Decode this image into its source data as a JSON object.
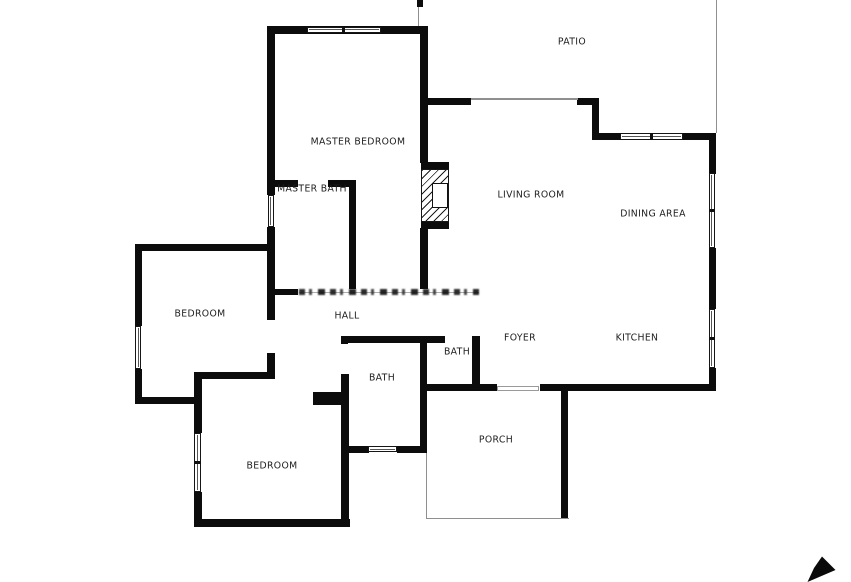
{
  "title": "Floor plan",
  "canvas": {
    "width": 851,
    "height": 582,
    "background": "#ffffff"
  },
  "colors": {
    "wall": "#0c0c0c",
    "thin_line": "#8f8f8f",
    "label_text": "#1c1c1c",
    "window_border": "#161616",
    "watermark": "#1e1e1e"
  },
  "rooms": [
    {
      "id": "patio",
      "label": "PATIO",
      "x": 572,
      "y": 42
    },
    {
      "id": "master-bedroom",
      "label": "MASTER BEDROOM",
      "x": 358,
      "y": 142
    },
    {
      "id": "master-bath",
      "label": "MASTER BATH",
      "x": 312,
      "y": 189
    },
    {
      "id": "living-room",
      "label": "LIVING ROOM",
      "x": 531,
      "y": 195
    },
    {
      "id": "dining-area",
      "label": "DINING AREA",
      "x": 653,
      "y": 214
    },
    {
      "id": "bedroom-left",
      "label": "BEDROOM",
      "x": 200,
      "y": 314
    },
    {
      "id": "hall",
      "label": "HALL",
      "x": 347,
      "y": 316
    },
    {
      "id": "foyer",
      "label": "FOYER",
      "x": 520,
      "y": 338
    },
    {
      "id": "kitchen",
      "label": "KITCHEN",
      "x": 637,
      "y": 338
    },
    {
      "id": "bath-small",
      "label": "BATH",
      "x": 457,
      "y": 352
    },
    {
      "id": "bath",
      "label": "BATH",
      "x": 382,
      "y": 378
    },
    {
      "id": "porch",
      "label": "PORCH",
      "x": 496,
      "y": 440
    },
    {
      "id": "bedroom-lower",
      "label": "BEDROOM",
      "x": 272,
      "y": 466
    }
  ],
  "walls": [
    [
      267,
      26,
      160,
      7.5
    ],
    [
      267,
      26,
      7.5,
      169
    ],
    [
      267,
      227,
      7.5,
      93
    ],
    [
      267,
      353,
      8,
      26
    ],
    [
      420,
      26,
      7.5,
      137
    ],
    [
      420,
      228,
      7.5,
      61
    ],
    [
      427,
      98,
      44,
      7
    ],
    [
      577,
      98,
      22,
      7
    ],
    [
      591.5,
      98,
      7,
      41
    ],
    [
      591.5,
      132.5,
      30,
      7.5
    ],
    [
      683,
      132.5,
      33,
      7.5
    ],
    [
      708.5,
      139,
      7,
      34.5
    ],
    [
      708.5,
      248,
      7,
      61
    ],
    [
      708.5,
      368,
      7,
      23
    ],
    [
      540,
      384,
      175.5,
      7
    ],
    [
      423,
      384,
      74,
      7
    ],
    [
      560.5,
      390.5,
      7.5,
      128
    ],
    [
      275,
      179.5,
      23,
      7
    ],
    [
      328,
      179.5,
      27.5,
      7
    ],
    [
      348.5,
      186,
      7,
      103
    ],
    [
      275,
      288.5,
      23,
      6.5
    ],
    [
      135,
      243.5,
      139.5,
      7.5
    ],
    [
      135,
      243.5,
      7,
      82.5
    ],
    [
      135,
      368.5,
      7,
      35.5
    ],
    [
      135,
      396.5,
      65,
      7.5
    ],
    [
      193.5,
      371.5,
      81.5,
      7.5
    ],
    [
      193.5,
      371.5,
      8,
      61.5
    ],
    [
      193.5,
      491.5,
      8,
      35
    ],
    [
      193.5,
      519,
      156.5,
      7.5
    ],
    [
      341,
      373.5,
      7.5,
      153
    ],
    [
      313,
      392,
      28,
      13
    ],
    [
      343,
      335.5,
      102,
      7
    ],
    [
      341,
      335.5,
      7,
      8
    ],
    [
      419.5,
      335.5,
      7,
      117
    ],
    [
      348.5,
      445.5,
      20,
      7
    ],
    [
      397,
      445.5,
      29.5,
      7
    ],
    [
      471.5,
      335.5,
      8,
      49.5
    ]
  ],
  "thin_lines": [
    [
      418,
      0,
      1.3,
      26
    ],
    [
      715.7,
      0,
      1.3,
      133
    ],
    [
      471,
      98.4,
      106.5,
      1.3
    ],
    [
      425.5,
      452.5,
      1.3,
      66
    ],
    [
      425.5,
      517.8,
      143,
      1.3
    ]
  ],
  "windows": [
    {
      "x": 306.5,
      "y": 26.5,
      "w": 74,
      "h": 6.5,
      "o": "h",
      "panes": 2
    },
    {
      "x": 267.5,
      "y": 195,
      "w": 6.5,
      "h": 32,
      "o": "v",
      "panes": 1
    },
    {
      "x": 135.3,
      "y": 326,
      "w": 6,
      "h": 42.5,
      "o": "v",
      "panes": 1
    },
    {
      "x": 194,
      "y": 433,
      "w": 7,
      "h": 58.5,
      "o": "v",
      "panes": 2
    },
    {
      "x": 368,
      "y": 446,
      "w": 29,
      "h": 6.3,
      "o": "h",
      "panes": 1
    },
    {
      "x": 620,
      "y": 133,
      "w": 63,
      "h": 6.5,
      "o": "h",
      "panes": 2
    },
    {
      "x": 708.7,
      "y": 173,
      "w": 6.5,
      "h": 75,
      "o": "v",
      "panes": 2
    },
    {
      "x": 708.7,
      "y": 309,
      "w": 6.3,
      "h": 59,
      "o": "v",
      "panes": 2
    }
  ],
  "door_frame": {
    "x": 497,
    "y": 385.5,
    "w": 42,
    "h": 5.5
  },
  "fireplace": {
    "x": 421,
    "y": 162,
    "w": 28,
    "h": 67
  },
  "watermark": {
    "x": 299,
    "y": 287.5,
    "w": 180,
    "h": 9
  },
  "top_tick": {
    "x": 417,
    "y": 0,
    "w": 6,
    "h": 6.5
  },
  "cursor_arrow": {
    "points": "822,556.5 835.5,570 807.5,582 814,568",
    "color": "#0a0a0a"
  }
}
